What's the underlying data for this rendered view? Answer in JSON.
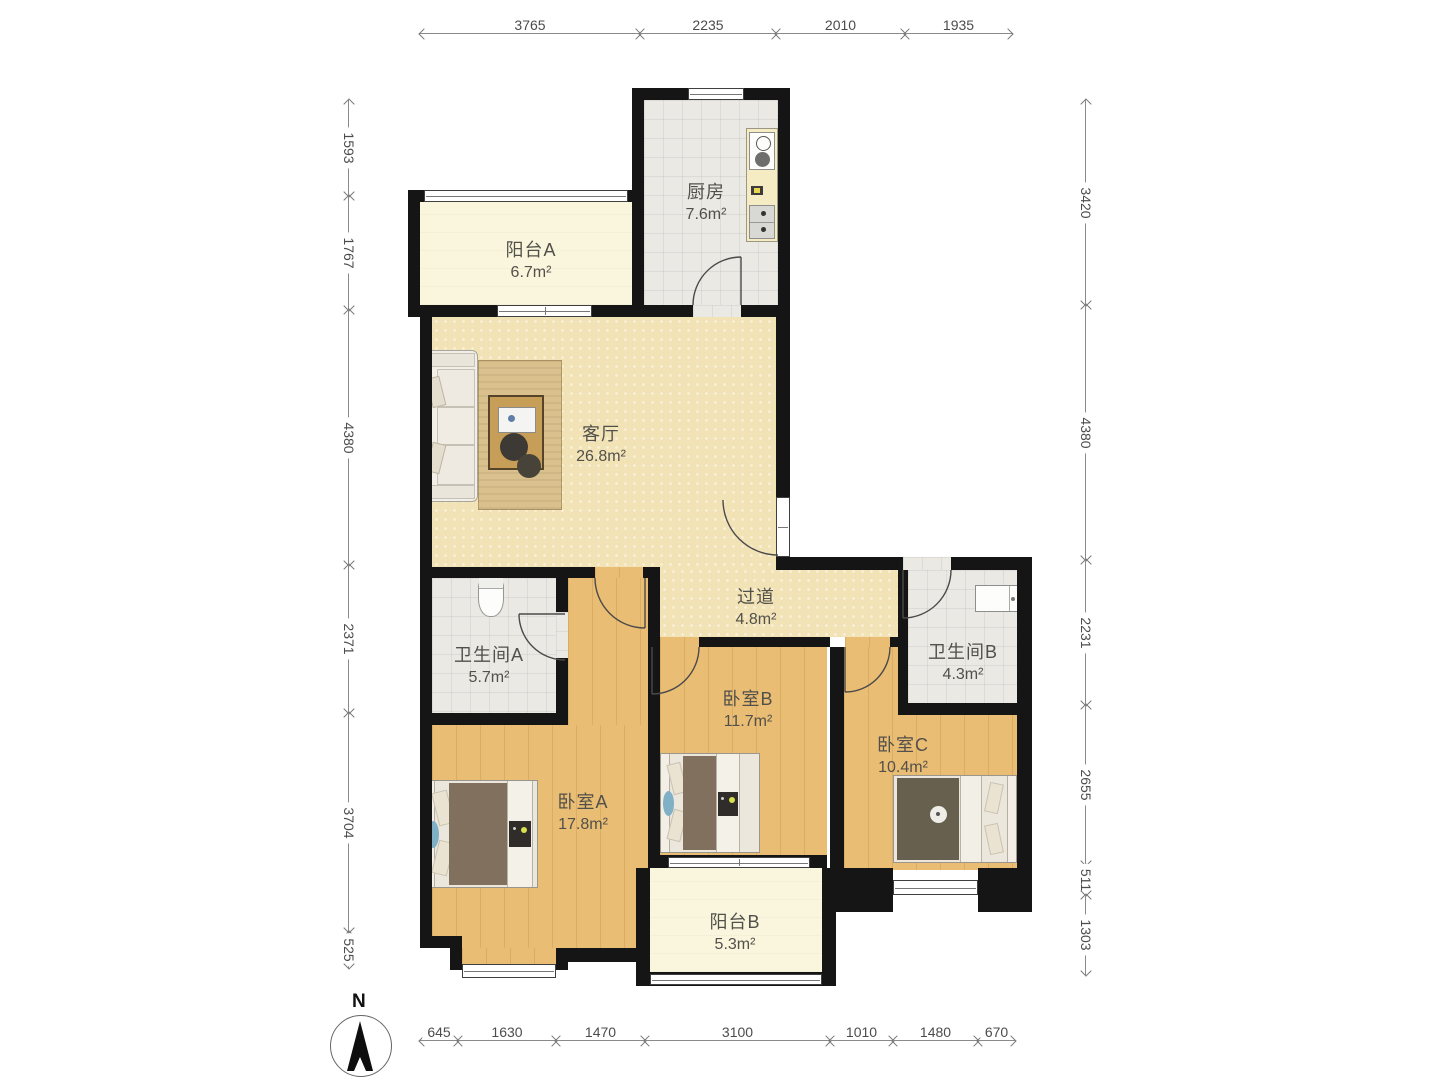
{
  "title": "三室两厅户型图",
  "rooms": {
    "kitchen": {
      "name": "厨房",
      "area": "7.6m²"
    },
    "balcony_a": {
      "name": "阳台A",
      "area": "6.7m²"
    },
    "living": {
      "name": "客厅",
      "area": "26.8m²"
    },
    "hallway": {
      "name": "过道",
      "area": "4.8m²"
    },
    "bath_a": {
      "name": "卫生间A",
      "area": "5.7m²"
    },
    "bath_b": {
      "name": "卫生间B",
      "area": "4.3m²"
    },
    "bedroom_a": {
      "name": "卧室A",
      "area": "17.8m²"
    },
    "bedroom_b": {
      "name": "卧室B",
      "area": "11.7m²"
    },
    "bedroom_c": {
      "name": "卧室C",
      "area": "10.4m²"
    },
    "balcony_b": {
      "name": "阳台B",
      "area": "5.3m²"
    }
  },
  "dimensions": {
    "top": [
      "3765",
      "2235",
      "2010",
      "1935"
    ],
    "left": [
      "1593",
      "1767",
      "4380",
      "2371",
      "3704",
      "525"
    ],
    "right": [
      "3420",
      "4380",
      "2231",
      "2655",
      "511",
      "1303"
    ],
    "bottom": [
      "645",
      "1630",
      "1470",
      "3100",
      "1010",
      "1480",
      "670"
    ]
  },
  "compass": {
    "label": "N"
  },
  "colors": {
    "wall": "#151515",
    "living_floor": "#f2e3b7",
    "wood_floor": "#eabd74",
    "tile_floor": "#ebe9e4",
    "balcony_floor": "#faf6dd",
    "dimension_text": "#4c4c4c"
  }
}
